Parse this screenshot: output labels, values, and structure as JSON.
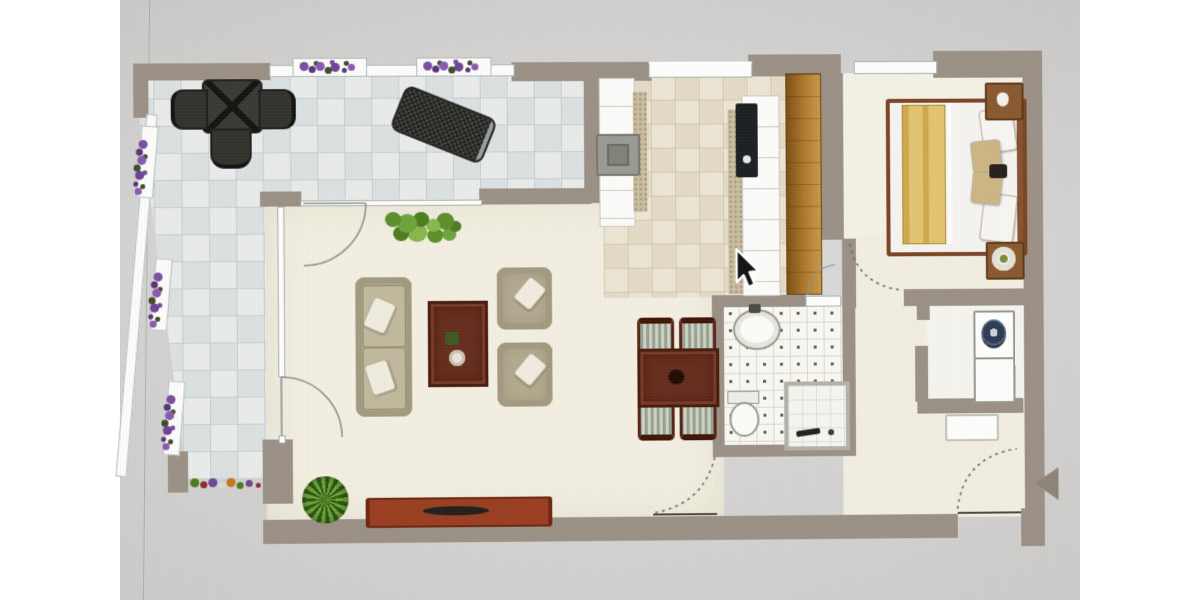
{
  "scene": {
    "kind": "floor-plan-photo",
    "has_visible_text": false,
    "cursor": {
      "x": 737,
      "y": 250,
      "style": "black-arrow-white-outline"
    }
  },
  "palette": {
    "page_background": "#ffffff",
    "photo_background": "#d8d7d5",
    "wall": "#9b9186",
    "terrace_tile": "#e8ebea",
    "terrace_grout": "#c6cccd",
    "cream_floor": "#f2efe2",
    "kitchen_tile": "#ece5d3",
    "bathroom_floor": "#f8f7f2",
    "wood_cabinet": "#a06c24",
    "wood_table_dark": "#662e1e",
    "console_rust": "#9a3f22",
    "sofa_beige": "#b2aa8e",
    "bed_frame": "#7b4526",
    "blanket_yellow": "#d9b95e",
    "flowers_purple": "#7b4fa0",
    "plant_green": "#5d8f2c",
    "outdoor_furniture_dark": "#34342f",
    "entrance_arrow": "#8e8479"
  },
  "plan": {
    "rooms": [
      {
        "id": "terrace",
        "features": [
          "tiled-floor",
          "outdoor-dining-table",
          "three-chairs",
          "sun-lounger",
          "purple-planter-boxes",
          "flower-bed",
          "railing"
        ]
      },
      {
        "id": "living-dining-room",
        "features": [
          "sofa",
          "two-armchairs",
          "coffee-table",
          "tv-console",
          "potted-plant",
          "green-bush",
          "dining-table-with-four-chairs",
          "glass-doors-to-terrace"
        ]
      },
      {
        "id": "kitchen",
        "features": [
          "left-counter-run",
          "stove",
          "right-counter-run",
          "black-cooktop",
          "tall-wood-cabinet",
          "window"
        ]
      },
      {
        "id": "bathroom",
        "features": [
          "sink",
          "toilet",
          "shower",
          "dotted-tile-floor"
        ]
      },
      {
        "id": "bedroom",
        "features": [
          "double-bed",
          "yellow-blanket",
          "pillows",
          "two-nightstands",
          "lamp",
          "window",
          "dashed-door-swing"
        ]
      },
      {
        "id": "laundry-nook",
        "features": [
          "washing-machine",
          "white-appliance"
        ]
      },
      {
        "id": "entry-hall",
        "features": [
          "shoe-cabinet",
          "entrance-door-swing-dashed",
          "entrance-arrow-marker"
        ]
      }
    ]
  }
}
